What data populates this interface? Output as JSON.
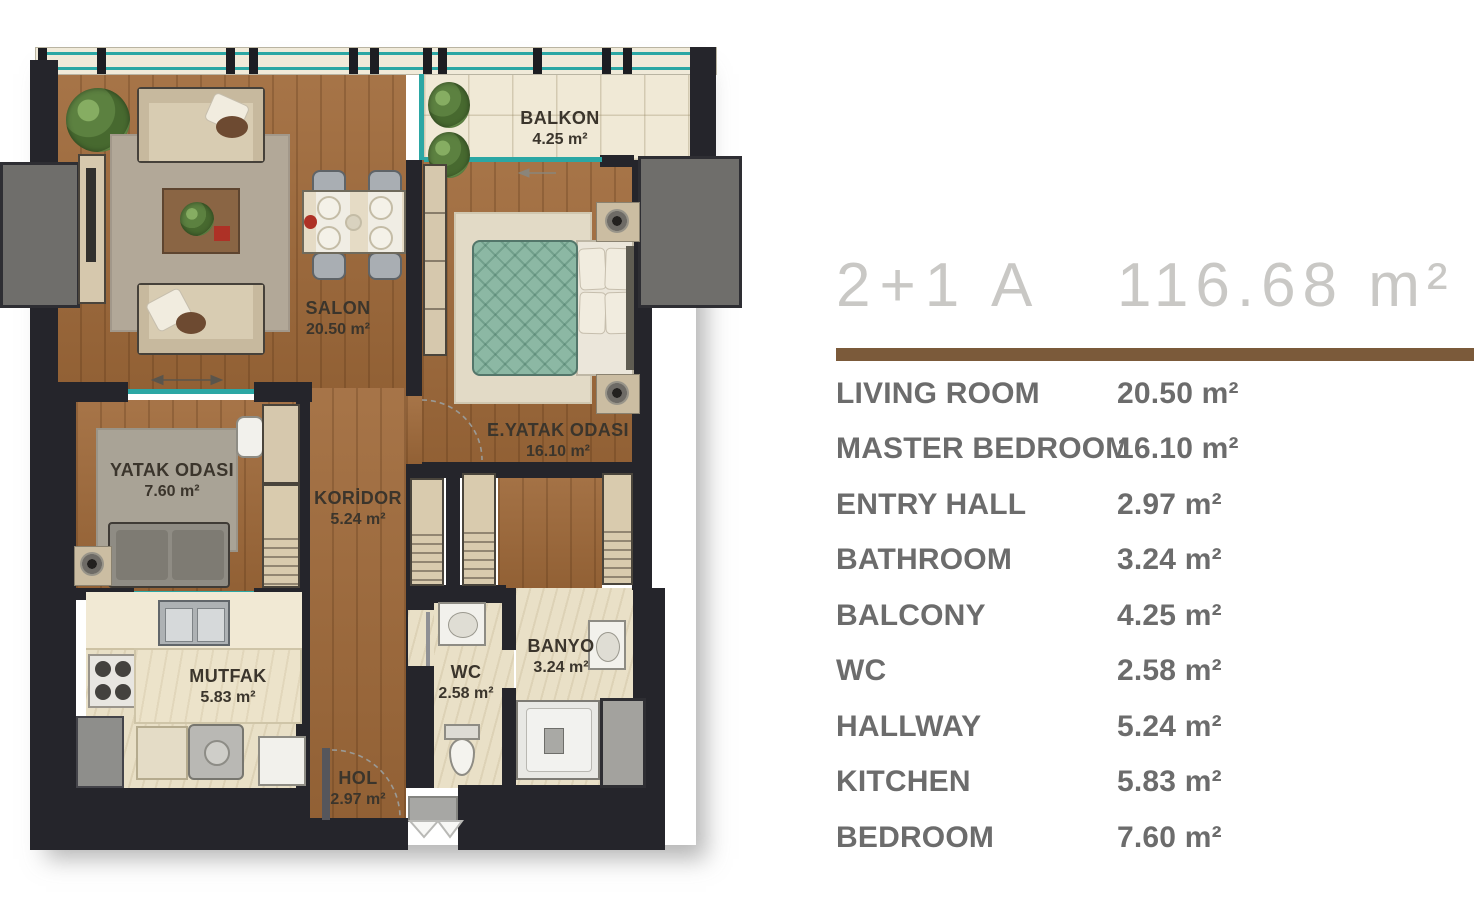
{
  "legend": {
    "title": "2+1 A",
    "total_area": "116.68 m²",
    "accent_color": "#7b5a3a",
    "text_color": "#6c6c6c",
    "title_color": "#c9c8c5",
    "rows": [
      {
        "label": "LIVING ROOM",
        "value": "20.50 m²"
      },
      {
        "label": "MASTER BEDROOM",
        "value": "16.10 m²"
      },
      {
        "label": "ENTRY HALL",
        "value": "2.97 m²"
      },
      {
        "label": "BATHROOM",
        "value": "3.24 m²"
      },
      {
        "label": "BALCONY",
        "value": "4.25 m²"
      },
      {
        "label": "WC",
        "value": "2.58 m²"
      },
      {
        "label": "HALLWAY",
        "value": "5.24 m²"
      },
      {
        "label": "KITCHEN",
        "value": "5.83 m²"
      },
      {
        "label": "BEDROOM",
        "value": "7.60 m²"
      }
    ]
  },
  "floor_labels": {
    "balkon": {
      "name": "BALKON",
      "area": "4.25 m²"
    },
    "salon": {
      "name": "SALON",
      "area": "20.50 m²"
    },
    "e_yatak": {
      "name": "E.YATAK ODASI",
      "area": "16.10 m²"
    },
    "yatak": {
      "name": "YATAK ODASI",
      "area": "7.60 m²"
    },
    "koridor": {
      "name": "KORİDOR",
      "area": "5.24 m²"
    },
    "mutfak": {
      "name": "MUTFAK",
      "area": "5.83 m²"
    },
    "banyo": {
      "name": "BANYO",
      "area": "3.24 m²"
    },
    "wc": {
      "name": "WC",
      "area": "2.58 m²"
    },
    "hol": {
      "name": "HOL",
      "area": "2.97 m²"
    }
  },
  "plan_colors": {
    "wall": "#25252b",
    "wood": "#a06a3a",
    "tile": "#f0e9d6",
    "window_teal": "#2ba7a4",
    "column_gray": "#6f6e6b",
    "bed_green": "#8cb8a4"
  }
}
